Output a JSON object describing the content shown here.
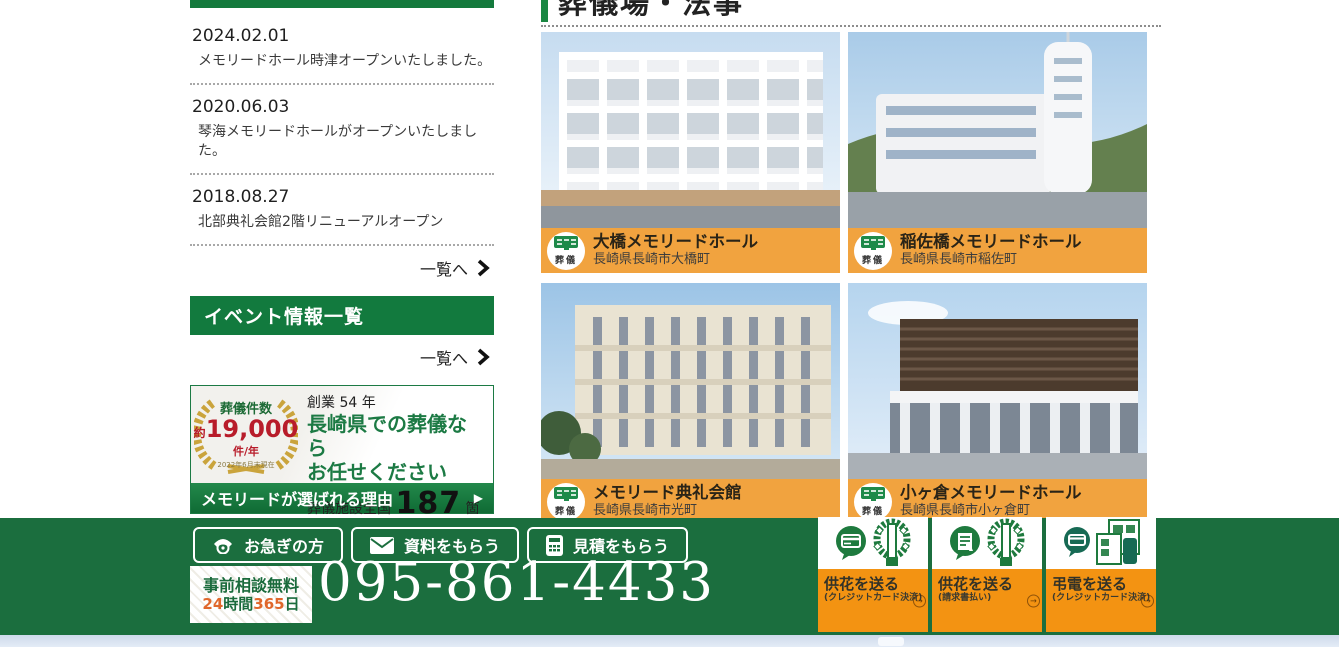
{
  "colors": {
    "brand_green": "#1b6e3e",
    "header_green": "#127a3e",
    "label_orange": "#f1a33f",
    "banner_orange": "#f39312",
    "badge_red": "#b81c2a",
    "number_orange": "#e0672b"
  },
  "sidebar": {
    "news": {
      "items": [
        {
          "date": "2024.02.01",
          "text": "メモリードホール時津オープンいたしました。"
        },
        {
          "date": "2020.06.03",
          "text": "琴海メモリードホールがオープンいたしました。"
        },
        {
          "date": "2018.08.27",
          "text": "北部典礼会館2階リニューアルオープン"
        }
      ],
      "more_label": "一覧へ"
    },
    "event_header": "イベント情報一覧",
    "event_more_label": "一覧へ",
    "promo": {
      "badge_title": "葬儀件数",
      "badge_approx": "約",
      "badge_number": "19,000",
      "badge_unit": "件/年",
      "badge_note": "2022年6月末現在",
      "founded": "創業 54 年",
      "line1": "長崎県での葬儀なら",
      "line2": "お任せください",
      "facilities_prefix": "葬儀施設全国",
      "facilities_number": "187",
      "facilities_suffix": "箇所",
      "facilities_note": "2020年6月末現在",
      "cta": "メモリードが選ばれる理由",
      "cta_arrow": "▶"
    }
  },
  "main": {
    "heading": "葬儀場・法事",
    "cards": [
      {
        "badge": "葬儀",
        "name": "大橋メモリードホール",
        "address": "長崎県長崎市大橋町"
      },
      {
        "badge": "葬儀",
        "name": "稲佐橋メモリードホール",
        "address": "長崎県長崎市稲佐町"
      },
      {
        "badge": "葬儀",
        "name": "メモリード典礼会館",
        "address": "長崎県長崎市光町"
      },
      {
        "badge": "葬儀",
        "name": "小ヶ倉メモリードホール",
        "address": "長崎県長崎市小ヶ倉町"
      }
    ]
  },
  "footer": {
    "buttons": [
      {
        "label": "お急ぎの方"
      },
      {
        "label": "資料をもらう"
      },
      {
        "label": "見積をもらう"
      }
    ],
    "consult": {
      "line1": "事前相談無料",
      "hours_num": "24",
      "hours_label": "時間",
      "days_num": "365",
      "days_label": "日"
    },
    "phone_number": "095-861-4433",
    "banners": [
      {
        "title": "供花を送る",
        "subtitle": "(クレジットカード決済)",
        "arrow": "→"
      },
      {
        "title": "供花を送る",
        "subtitle": "(請求書払い)",
        "arrow": "→"
      },
      {
        "title": "弔電を送る",
        "subtitle": "(クレジットカード決済)",
        "arrow": "→"
      }
    ]
  }
}
